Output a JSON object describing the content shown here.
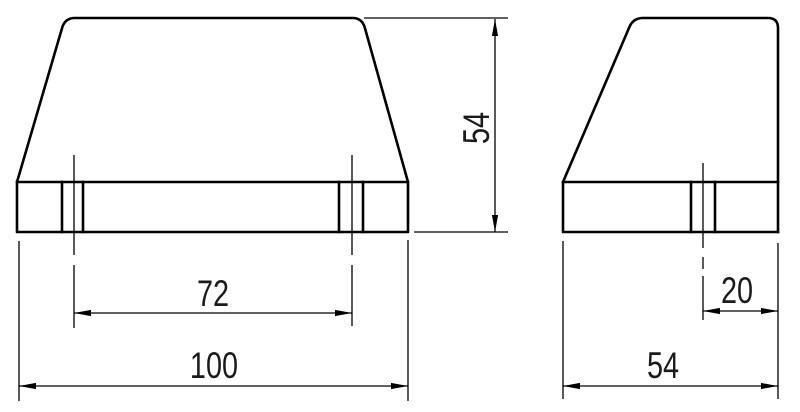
{
  "drawing": {
    "background_color": "#ffffff",
    "line_color": "#000000",
    "text_color": "#1a1a1a",
    "dims": {
      "front_total": "100",
      "front_inner": "72",
      "height": "54",
      "side_total": "54",
      "side_inner": "20"
    }
  }
}
